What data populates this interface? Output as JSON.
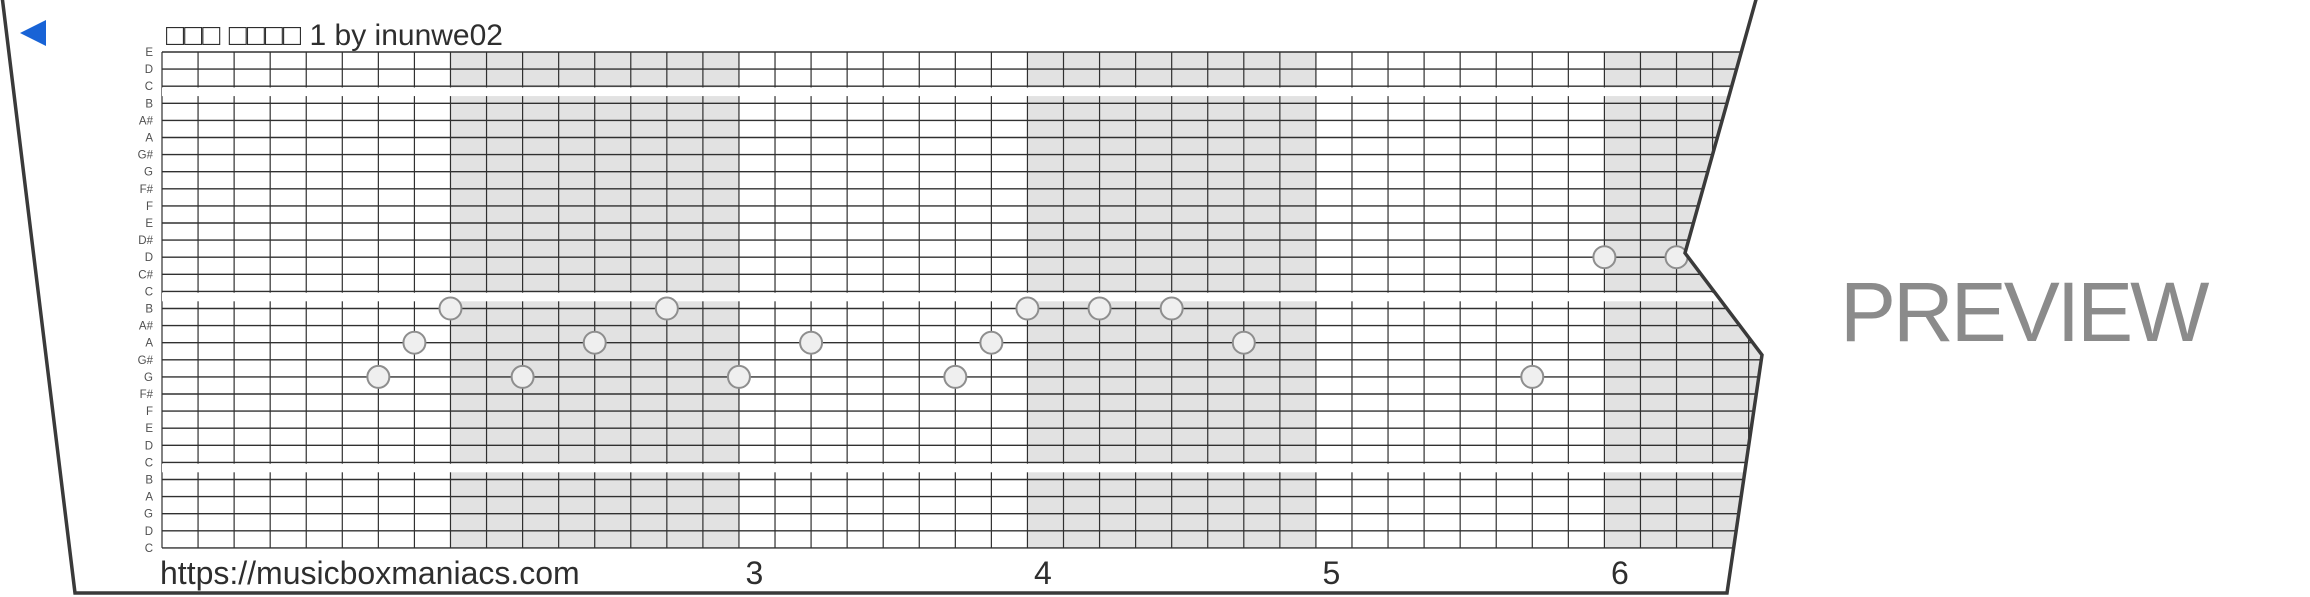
{
  "title": "□□□ □□□□ 1 by inunwe02",
  "watermark": "PREVIEW",
  "footer": {
    "url": "https://musicboxmaniacs.com",
    "beat_numbers": [
      {
        "label": "3",
        "col": 16
      },
      {
        "label": "4",
        "col": 24
      },
      {
        "label": "5",
        "col": 32
      },
      {
        "label": "6",
        "col": 40
      }
    ]
  },
  "icons": {
    "play": "left-pointing-triangle"
  },
  "colors": {
    "accent_blue": "#1863d6",
    "grid_line": "#303030",
    "band_gray": "#e2e2e2",
    "note_fill": "#efefef",
    "note_stroke": "#8e8e8e",
    "text_dark": "#2e2e2e",
    "label_gray": "#4f4f4f",
    "watermark_gray": "#8b8b8b",
    "strip_border": "#3a3a3a"
  },
  "grid": {
    "note_labels": [
      "E",
      "D",
      "C",
      "B",
      "A#",
      "A",
      "G#",
      "G",
      "F#",
      "F",
      "E",
      "D#",
      "D",
      "C#",
      "C",
      "B",
      "A#",
      "A",
      "G#",
      "G",
      "F#",
      "F",
      "E",
      "D",
      "C",
      "B",
      "A",
      "G",
      "D",
      "C"
    ],
    "octave_group_sizes": [
      3,
      12,
      10,
      5
    ],
    "octave_gap_after_line": [
      2,
      14,
      24
    ],
    "gray_band_every_cells": 8,
    "notes": [
      {
        "col": 6,
        "line": 19,
        "note": "G"
      },
      {
        "col": 7,
        "line": 17,
        "note": "A"
      },
      {
        "col": 8,
        "line": 15,
        "note": "B"
      },
      {
        "col": 10,
        "line": 19,
        "note": "G"
      },
      {
        "col": 12,
        "line": 17,
        "note": "A"
      },
      {
        "col": 14,
        "line": 15,
        "note": "B"
      },
      {
        "col": 16,
        "line": 19,
        "note": "G"
      },
      {
        "col": 18,
        "line": 17,
        "note": "A"
      },
      {
        "col": 22,
        "line": 19,
        "note": "G"
      },
      {
        "col": 23,
        "line": 17,
        "note": "A"
      },
      {
        "col": 24,
        "line": 15,
        "note": "B"
      },
      {
        "col": 26,
        "line": 15,
        "note": "B"
      },
      {
        "col": 28,
        "line": 15,
        "note": "B"
      },
      {
        "col": 30,
        "line": 17,
        "note": "A"
      },
      {
        "col": 38,
        "line": 19,
        "note": "G"
      },
      {
        "col": 40,
        "line": 12,
        "note": "D"
      },
      {
        "col": 42,
        "line": 12,
        "note": "D"
      }
    ]
  }
}
